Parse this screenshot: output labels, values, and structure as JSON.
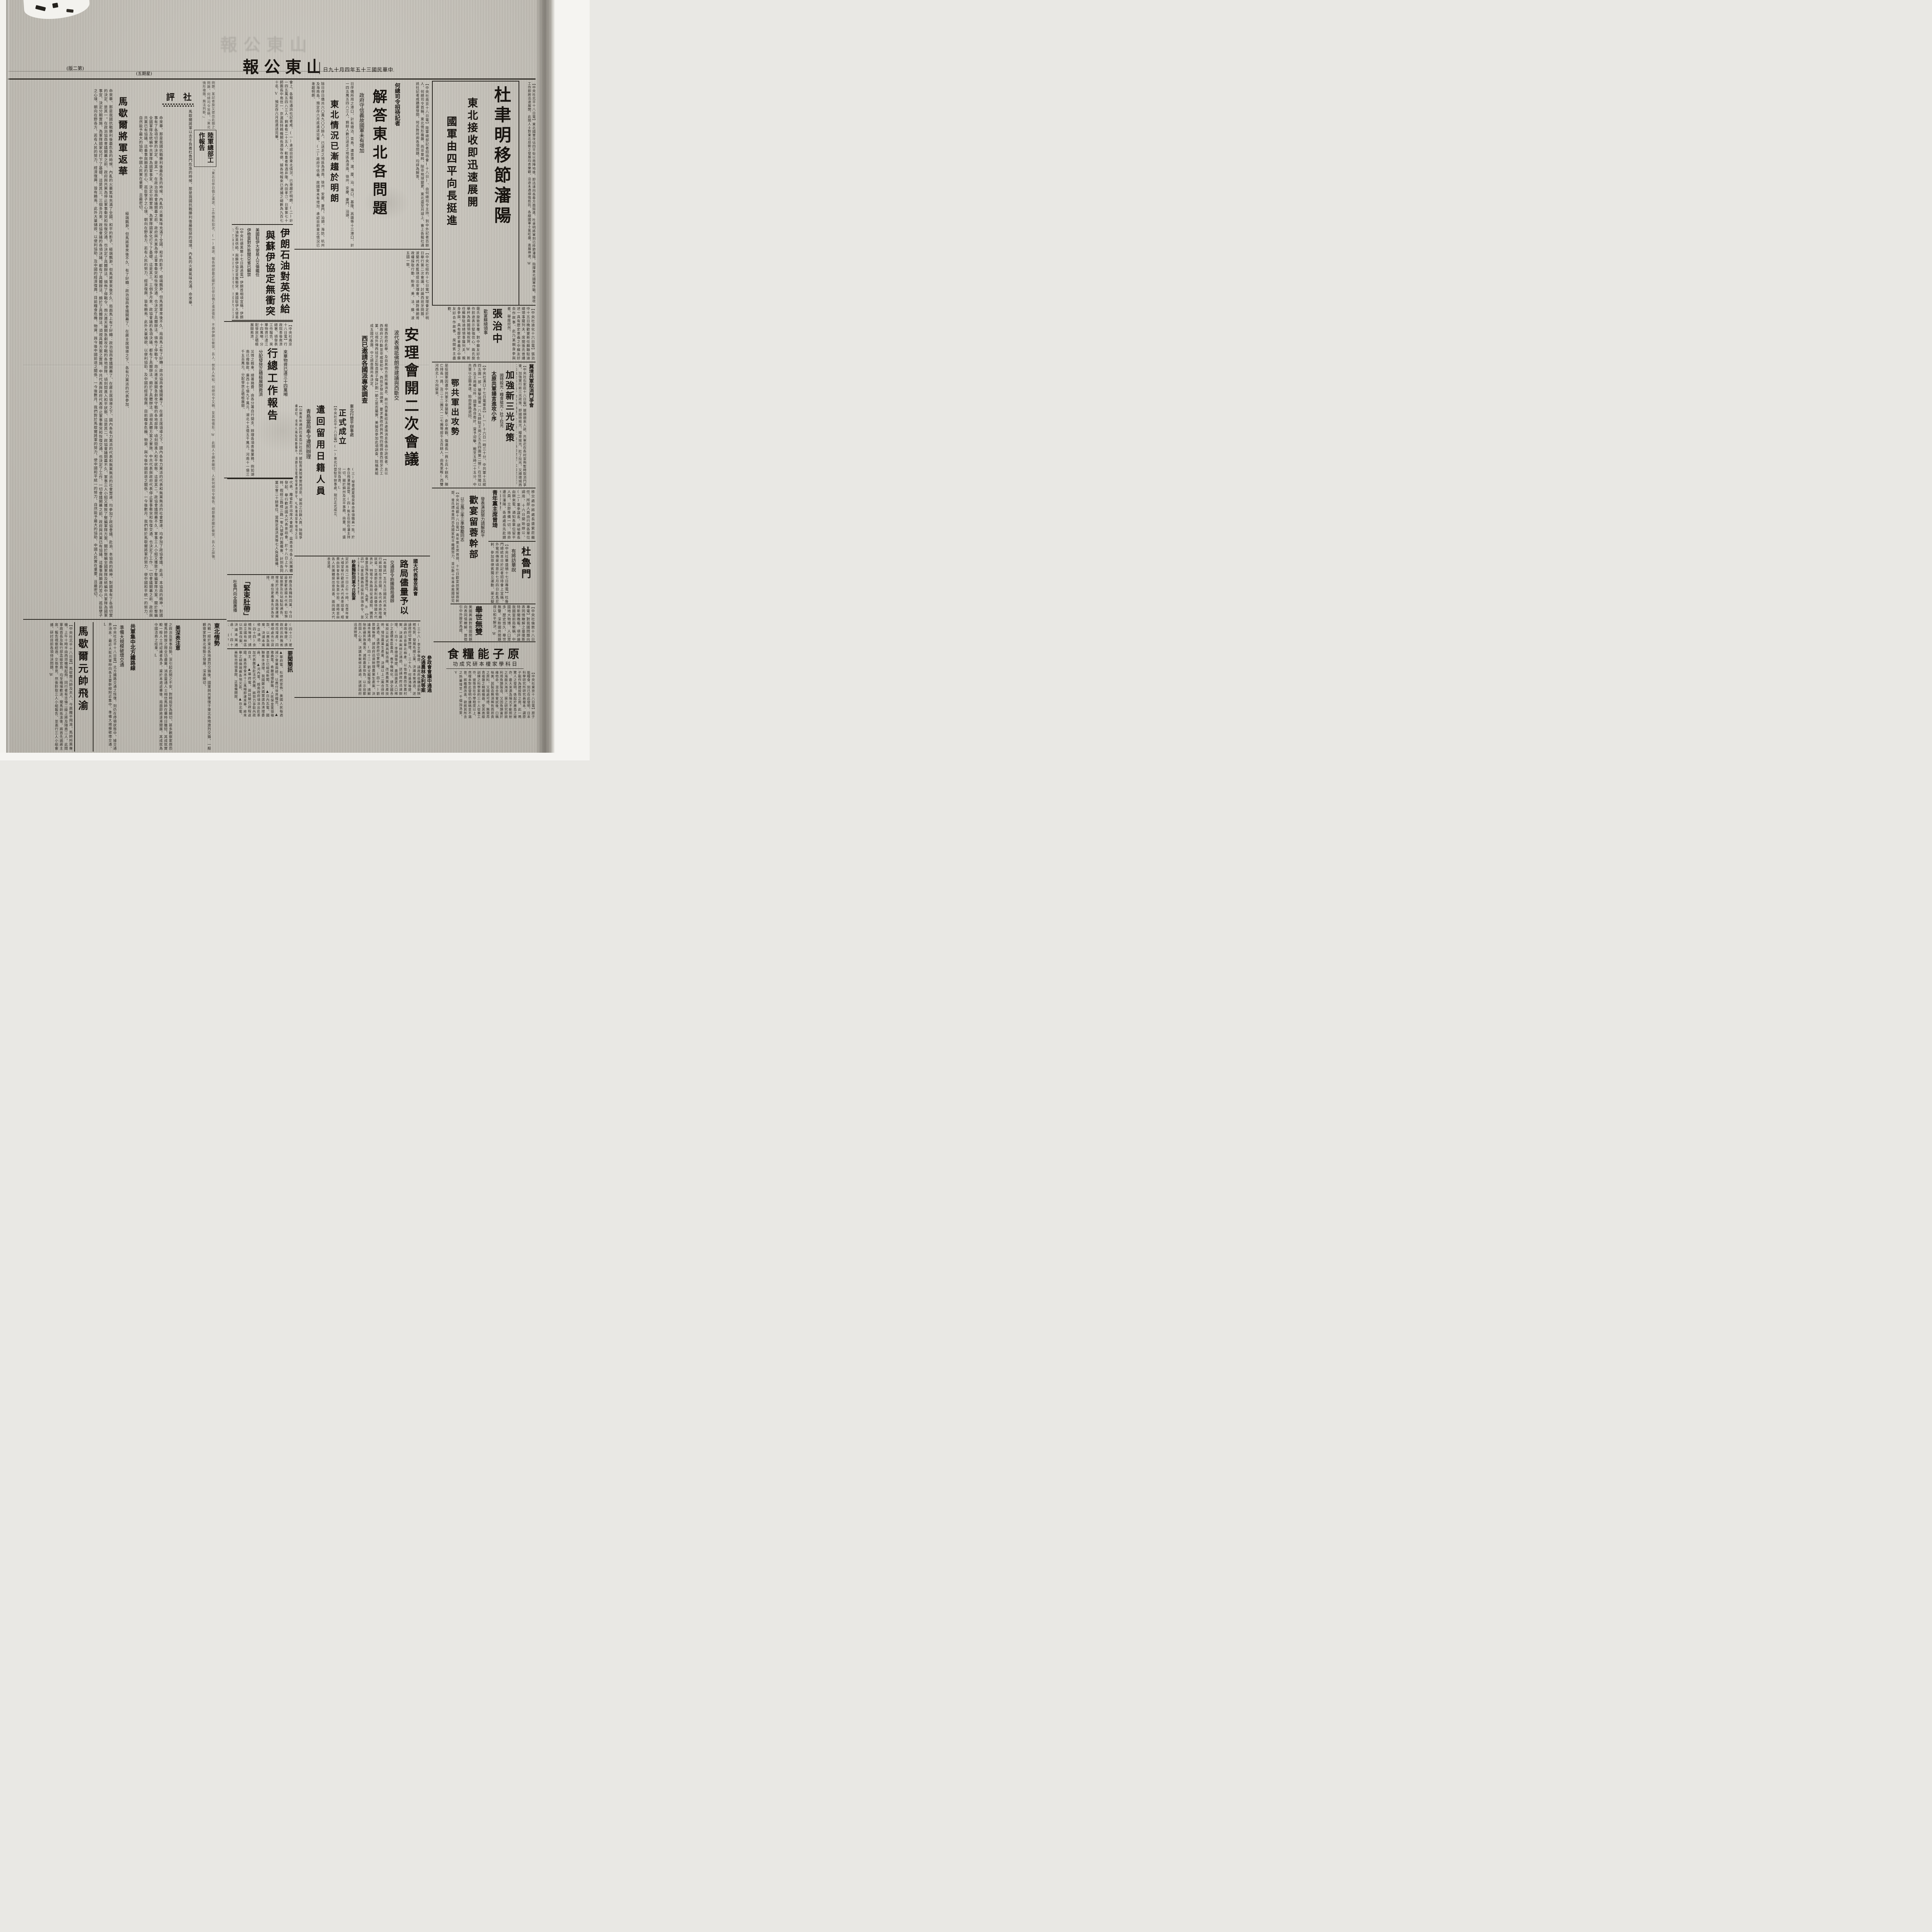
{
  "page": {
    "publication": "山東公報",
    "date_line": "中華民國三十五年四月十九日",
    "page_label": "(第二版)",
    "weekday_label": "(星期五)"
  },
  "du": {
    "headline": "杜聿明移節瀋陽",
    "sub1": "東北接收即迅速展開",
    "sub2": "國軍由四平向長挺進",
    "story": "【中央社北平十八日電】東北國軍攻佔四平街以南陣地後、即迅速向長春方面挺進、杜聿明將軍刻已移節瀋陽、指揮東北國軍作戰、接收工作即將迅速展開、此間人士對東北局勢之發展均表樂觀、沿途未遇頑強抵抗、各線國軍士氣旺盛、進展神速、W"
  },
  "zhang": {
    "headline": "張治中",
    "subhead": "歡宴蘇總領事",
    "story_a": "【中央社迪化十六日電】張治中十五日晚歡宴新任蘇聯駐迪總領事薩列夫、席間張氏曾講述一具有歷史意義之中蘇友好合作故事、此乃某親身參與者、舉座欣然、",
    "story_b": "薩氏旋致答覆、對中蘇友好合作前途表示堅強信心、兩氏旋舉杯為兩國領袖祝賀、W　新任蘇聯駐迪總領事薩列夫、親身參與、具有歷史意義之中蘇友好合作故事、席間賓主盡歡、"
  },
  "egong": {
    "headline": "鄂共軍出攻勢",
    "story_a": "【中央社漢口十七日電軍息】(一)十六日一時三十分、中共軍十五縱四五團一部、襲擊國軍一八五師駐王崗之五五四團第二營(在信陽以西)及王崗鄉公所、國軍為自衛計、當予迎擊、戰至五時二十五分、中共軍以企圖未遑、始由原路退回、",
    "story_b": "是役國軍因遭中共軍不意襲擊、倉卒應戰、傷連長一員士兵十餘名、陣亡排長一員、及二十二團又一二七團等部千五百餘人、由馬家畈(西雙河西北)方向竄來、"
  },
  "jijing": {
    "section_header": "冀境共軍取消鬥爭會",
    "headline": "加強新三光政策",
    "subhead": "國特殺光・糧食搶光・壯丁拉光",
    "headline2": "太原共軍揚言進攻小序",
    "story": "【中央社石家莊十八日電】據順德來人談、共軍近在各村宣佈暫時取消鬥爭會、加強實行新三光政策、即國特殺光、糧食搶光、壯丁拉光、又順德城西仁和鎮公所夫役、被共軍捕獲、於三月二十日在縣西被剝、成肉泥而死、【中央社太原十七日電】四月五六兩日、共軍第十一十二兩團約四千餘人、襲擊國軍駐太原縣屬北橋圍石莊村一帶、揚言將進攻小序鎮、迫令村民毀壞國民黨三名至五名、否則村長及幹部均須受罰、"
  },
  "qingnian": {
    "headline": "青年黨主席曾琦",
    "story": "移交處中將處長盛紫莊繼任、所部人員由行營各單位調用、十六日開始辦公、(二)董參謀長、胡祕書長由錦來電、通知各單位留平人員、立即準備一切、待命遷往瀋陽、各處處長先赴錦州再行轉瀋、"
  },
  "huanyan": {
    "headline": "歡宴留蓉幹部",
    "subhead_right": "發表演說努力調解和平",
    "subhead_left": "以三風三率三準勉勵同志",
    "story": "【中央社成都十八日電】青年黨主席曾琦、十七日歡宴該黨留蓉幹部、曾氏謂本黨同志為國家和平繼續努力、並以數十年革命救國研究體驗所得之經驗、提出原則數項、勗勉同志、(一)以三風做人、即風度、風骨、風誼、(二)以三率辦事、即能率、效率、速率、能率是甲能辦一件事、乙能辦二事件、則乙之能率高、效率是甲辦十件事一件收效、乙辦十件事九件收效、則乙之效率大於甲、今後如照政治協商會議協議施行則治、反此則難免於亂、"
  },
  "dulumen": {
    "headline": "杜魯門",
    "subhead": "有將訪華說",
    "story": "【中央社華盛頓十七日專電】杜魯門總統本日於記者招待會上宣稱、外電所傳渠頃思於七月四日赴馬尼剌、參加菲律賓獨立運動、渠尤擬訪問日本、惟須視當時渠之日程及情形而定、L"
  },
  "jushi": {
    "headline": "舉世無雙",
    "story_right": "【中央社倫敦十八日專電】對我國問題向表同情瞭解之曼徹斯特新聞晚報、頃評論我國當前局勢稱、中國地大物博、人口眾多、歷史悠久、舉世無雙、深盼國共問題得以和平解決、W",
    "story_left": "美國輿論對我國問題向表同情瞭解、曾徵引中外歷史為證、"
  },
  "yuanzi": {
    "headline": "原子能糧食",
    "subhead": "日科學家榎本研究成功",
    "story": "【中央社東京十八日電】原子能糧食、刻已在此發明、日本科學研究所研究員榎本、謂原子能作為建設性之用、此一鳴驚人之發明、係起於廣島之被炸、最大來源為陽光不斷照射之海面大海洋、渠之研究即欲利用魚類製造、又因魚類富於維他命、混合物嘗試後、口稱味美、其製造無須稀有而昂貴之原料、又隨處可得、無需昂貴複雜之精確機器、受其高級訓練之科學家約三十人從事工作、彼等皆在中學程度以上、然榎本對此發明仍謙稱並不滿意、將繼續改進、欲將其所含之熱量增至一千個加洛里、V"
  },
  "canzheng": {
    "headline_line1": "參政會會議中通過",
    "headline_line2": "交通農林水利等案"
  },
  "proposals": {
    "story_main": "(三十八)李芝亭等提、請政府收購過剩陝棉毛質、發展毛織工業、決議本案通過、送請政府切實辦理、(三十九)何基鴻等提、請政府注意華北棉產、以恤棉農而安農村案、決議本案修正通過、送請政府迅速辦理、(四十)李德淵等提、農田廣袤人口稀少之邊疆省區農具、應予機械化、請全國各省設立新式農具製造廠、改進農業生產技術、增加農業生產案、決議以上二案合併修正通過、送請政府切實辦理、(四十一)劉景健等提、請政府迅速辦理農業生產案、決議本案通過、(四十二)劉文龍等提、請解除新疆民族痛苦、減輕農家担負、以示拾郵而固人心案、決議本案修正通過、送請政府迅速辦理、",
    "story_left": "(四十三)翟倉陸等提、請政府迅飭豫省棉花增產、四鄉總處充分貸款、以應急需案、決議本案修正通過、(四十四)余楠秋等提、請設立國有林區以防濫伐案、決議本案通過、(四十五)趙舒等提、為發展沿海漁業應設立漁業銀行案、送請政府辦理、"
  },
  "yaowen": {
    "headline": "要聞簡訊",
    "briefs": [
      "▲華府電、杜總統宣佈、美國人民每週減少食量兩磅、以應付世界糧荒、",
      "▲雅典電、希臘總理辭職、人民保皇黨領袖達雷士已組成新閣、",
      "▲日內瓦電、國聯着手清理、我國鄭天錫當選為清理委員、",
      "▲河內電、越南政府頃派出赴茶加代表團及赴法代表團、將努力爭取內政自主、",
      "▲華府電、蔣廷黻已啟程返國、美商撥食米十二萬噸即運來華、將來華之胡佛視察各地災區、",
      "▲台北電、美駐台總領事館、正籌備開館、"
    ]
  },
  "he": {
    "label": "何總司令招待記者",
    "headline": "解答東北各問題",
    "sub1": "政府守信義故國軍未有增加",
    "sub2": "東北情況已漸趨於明朗",
    "story_right": "【中央社南京十八日電】陸軍總部記者招待會(十八日)、由何總司令主持、到中外記者百餘人、何總司令首稱、東北情形複雜、而非單純、除非地球變更、東北還至月球上、會上各報社通訊社記者咸踴躍發問、何氏對所詢各項問題、均詳為解答、",
    "story_mid": "日俘僑所用之港口、計有塘沽、青島、連雲港、滬、廈、汕、海口、基隆、高雄等十三港口、計一四五萬五四八三人、剩餘人數已送走之地區為濟南、徐州、安慶、廈門、汕頭、",
    "story_left": "除日俘日僑共六〇萬九〇〇餘人、已送走之地區為濟南、徐州、安慶、廈門、汕頭、海防、杭州及海南島、預定存六月底遣送完畢、(二)政府守信義、故國軍未有增加、承認目前東北情況已漸趨明朗、",
    "story_far": "會上、各報社通訊社記者咸、(一)承認目前東北情況、已漸趨於明朗、(二)計一四五萬五四八三人、剩者有二十五人、較重者有酒井隆、內田孝汀、日軍第七十師團長中島信一、京滬區特務機關長酒保寺德、據各地報來已逮捕之總數為九百七十名、V　預定存六月底遣送完畢、"
  },
  "yilang": {
    "headline1": "伊朗石油對英供給",
    "headline2": "與蘇伊協定無衝突",
    "sub1": "美國駐伊大使易人艾倫繼任",
    "sub2": "伊檢查對外新聞亞省已解禁",
    "story": "【中央社德黑蘭十七日路透電】伊朗首相頃宣稱、伊朗石油對英供給、與蘇伊協定並無衝突、美國駐伊大使易人、艾倫繼任、伊檢查對外新聞制度、亞塞拜然省已解禁、"
  },
  "anli": {
    "headline": "安理會開二次會議",
    "sub1": "波代表痛詆佛朗哥建議與西斷交",
    "sub2": "西已邀請各國派專家調查",
    "story_top": "【中央社紐約十七日電】安理會定於明日舉行第二次會議、討論西班牙問題、波蘭代表藍琪提出安理會、請對佛朗哥政權採取行動、盼英、美、法、蘇、波五國一致、",
    "story_a": "根據西政府此舉、及自其他方面所獲消息、將以西軍集結法邊境消息係過分誇張者、且以西政府之行動並非威脅和平、西班牙發出請柬、要求美政府與其他四國調查西班牙之工業、以視外傳西班牙正製造原子彈計劃一節之是否屬實、美擬否參加此項調查、院稱美組成五國代表團、中之調查團尚未決定、"
  },
  "xingzong": {
    "headline": "行總工作報告",
    "sub_right": "來華物資已達三十四萬噸",
    "sub_left": "分配發放正積極展開救濟",
    "story_top": "【中央社南京十八日電】行政院善後救濟總署、頃發表工作報告、來華物資已達三十四萬噸、分配發放正積極展開救濟、",
    "story": "災情之輕重、總署務費、由各分署自行開支、辦理各項善後業務、例如湖南已撥賑款、廣西十七億九千萬元、湖北十五億五千萬元、河南十一億三千五百萬元、分配發放正積極展開、"
  },
  "qianhui": {
    "headline": "遣回留用日籍人員",
    "subhead": "青島當局奉令遵照辦理",
    "story": "【山東青年通訊社青島分社訊】據駐青美陸軍當局消息、留用之日籍人員、除戰爭嫌疑犯、技術人員及其眷屬外、頃顧主任電轉陸軍總部令、凡各機絡部隊徵用之日籍人員、均予遣送返國、聞當局已遵照辦理云、V"
  },
  "xingying": {
    "label": "東北行營平辦事處",
    "headline": "正式成立",
    "story_1": "【中央社北平十八日電】(一)東北行營駐平辦事處、現已正式成立、",
    "story_2": "(三)祕書處夏祖良奉命率領職員一批、於本日飛瀋陽設營、(四)熊主任刻在瀋主持一切、關於錦州及北平事務、由董、胡、盛分別負責、L"
  },
  "luju": {
    "kicker": "國大代表晉京與會",
    "headline": "路局儘量予以便利",
    "subhead": "交通部令飭鐵路局遵辦",
    "sha_headline": "紗廠麵粉同業今日設宴",
    "story": "【本報訊】五月五日國民代表大會、行將如期在京召開、各代表亦將陸續就道、交通部近為便利與優待國大代表計、特電令各路局從速遵照、購買車票及預為妥籌座位、為要、B　【又訊】山東區鐵路局接到該項命令、並分別轉知各站遵照辦理、"
  },
  "chahua": {
    "story_1": "代表、離省赴京出席大會期近、茲悉本市各人民團體發起、舉行歡送國大代表茶話會、於十八日上午八時、假經三路緯三路一零九號舉行籌備會、計到各同業公會二十餘單位、當推定袁洪英等七人負責籌備、",
    "story_2": "定於本月二十日上午十時、在青年會大禮堂舉行歡送國大代表茶話會、經費由到會各單位負責分担、屆時並由各人民團體提出意見書、面向國大代表呈遞、",
    "story_3": "紗廠及各麵粉同業、今日設宴歡送國大代表、如預留座票及在站黏貼通告、俾易於洽悉、各路客運擁擠、座位更應事先妥為安排、"
  },
  "jsdd": {
    "headline": "「緊束肚帶」",
    "subhead": "杜魯門向全國廣播"
  },
  "shiping": {
    "label": "社評",
    "title": "馬歇爾將軍返華",
    "body_1": "命來華、那是我國抗戰勝利後最危急的時候、內亂的火藥氣味充滿了全國、和平的影子、極端飄渺。但馬將軍來後不久、局面馬上有了好轉：政治協商會議開幕了、在蔣主席領導之下、國內各有力黨派的代表和無黨無派的社會賢達、均參加了政協會議、赴渝、本協商的精神、對國事有了各項切實的決定、是其一。在政治協商會議開幕之前、政府與共黨為停止軍事衝突和恢復交通、也決定了具體辦法、頒佈了停戰令、炮火連天展開急劇攻守戰的各地部隊、頃刻間進入和平狀態、這是其二。政協會議閉幕不久、軍事三人小組又獲致了整編軍隊方案、關於整編全國軍隊及統編中共軍隊為國軍事宜、決定分期實施、為軍隊國家化打下了基礎、這是其三。三個多月來、政協會議的各項決議、都有了具體辦法、頗於了具體辦法、須視具體方案之實施、中共代表與政府代表停止軍事衝突和恢復交通、也決定了工作、一切會議開幕之前、政府與共黨已有協議、這番事與願違的苦心、孤臣孽子之心境、朝向在野各方、若有人民的努力、經濟復興、皆有賴焉、此外大量儲欲、以便利協助、及中國的經濟復興、目前糧食危機、物資、與今後中國前途之關係、一今後數月、我們對於馬歇爾將軍的努力、使中國和平統一的努力、自然能予最大的協助、中國人民實在重要、且最密切、",
    "body_2": "馬歇爾將軍以去冬負着杜魯門危急的時候、那是我國抗戰勝利後最險惡的環境、內亂的火藥氣味充滿、命來華、",
    "body_3": "極端飄渺。但馬將軍來後不久、有了好轉：政治協商會議開幕了、在蔣主席領導之下、各有力黨派的代表參加、",
    "strip_top": "問題、某記者旋又提出此類之問題、何總司令答稱、「東北情形複雜、無法判斷、」",
    "strip_bottom": "「東北日俘日僑之遣送、工作情形如次、(一)遣送、報告總部最近關於日俘日僑之遣送情形、不與伊朗以衝突、吾人、就吾人所知、何總司令又稱、至其他情形、W　此間人士頗表關切、人民何總司令報告、總部最近關於衝突、吾人之詳情、",
    "lz_header": "陸軍總部工作報告"
  },
  "bottom_left": {
    "dongbei_header": "東北情勢",
    "dongbei_story": "內戰一經於東北各地激烈交鋒後、國軍與共軍復于東北各地激烈交鋒、一般觀察家對東北情勢之發展、深表關切、",
    "meishen_header": "美深表注意",
    "meishen_story": "之政治及軍事局勢、深引起此間之不安、對時局至為關切、甚多觀察家感恐懼馬帥斡旋之際全功盡棄、消息靈通人士相信馬帥在華時日雖短、其成就實較一般人士所認識者為多、渠於本週返華後、局面即將逐漸開展、其成就為中國洽商之結果、L",
    "gongjun_headline": "共軍集中北方鐵路線",
    "gongjun_subhead": "準備大規模破壞交通",
    "gongjun_story": "【中央社北平十八日電】北方鐵路交通之恢復、刻仍在停頓狀態中、據交通界消息、最近大批共軍紛向各主要幹線附近集中、準備大規模破壞交通、L",
    "ma_headline": "馬歇爾元帥飛渝",
    "ma_story": "【中央社北平十八日電】馬歇爾元帥及夫人、今晨離平飛渝、馬帥所乘專機、上午十時半由西郊機場起飛、同行者有吉倫二級上將及隨員二人、此間軍政首長及執行部高級官員、均至機場歡送、聞馬帥抵渝後、將首先謁蔣主席、報告視察經過、交換意見、然後聆取三人小組報告、並進行三人小組會議、研討目前各項待決問題、W"
  }
}
